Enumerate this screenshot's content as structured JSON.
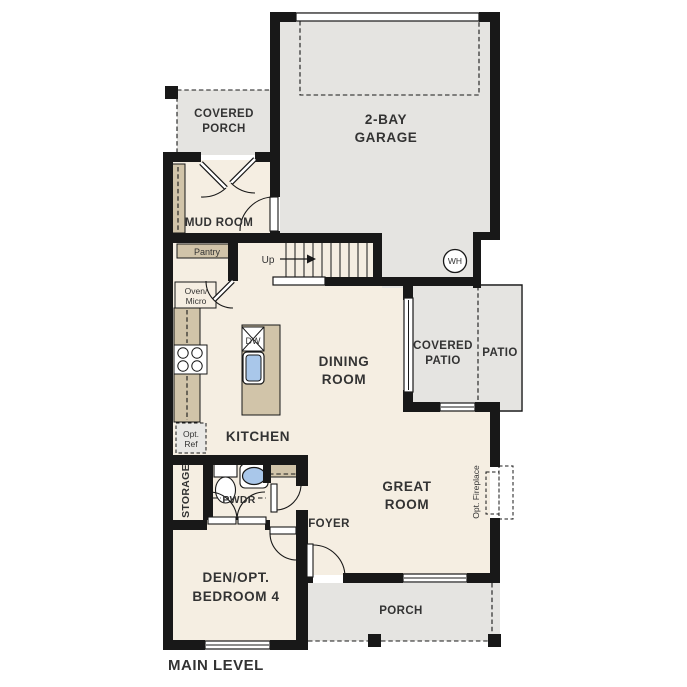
{
  "plan_title": "MAIN LEVEL",
  "rooms": {
    "garage": {
      "line1": "2-BAY",
      "line2": "GARAGE"
    },
    "covered_porch": {
      "line1": "COVERED",
      "line2": "PORCH"
    },
    "mud_room": {
      "label": "MUD ROOM"
    },
    "dining_room": {
      "line1": "DINING",
      "line2": "ROOM"
    },
    "kitchen": {
      "label": "KITCHEN"
    },
    "covered_patio": {
      "line1": "COVERED",
      "line2": "PATIO"
    },
    "patio": {
      "label": "PATIO"
    },
    "great_room": {
      "line1": "GREAT",
      "line2": "ROOM"
    },
    "powder": {
      "label": "PWDR"
    },
    "storage": {
      "label": "STORAGE"
    },
    "foyer": {
      "label": "FOYER"
    },
    "den": {
      "line1": "DEN/OPT.",
      "line2": "BEDROOM 4"
    },
    "porch": {
      "label": "PORCH"
    }
  },
  "fixtures": {
    "pantry": "Pantry",
    "oven_micro_line1": "Oven/",
    "oven_micro_line2": "Micro",
    "opt_ref_line1": "Opt.",
    "opt_ref_line2": "Ref",
    "dishwasher": "DW",
    "water_heater": "WH",
    "stairs_up": "Up",
    "opt_fireplace": "Opt. Fireplace"
  },
  "colors": {
    "floor": "#f5eee2",
    "outdoor": "#e5e4e1",
    "cabinet": "#d1c4a9",
    "wall": "#181818",
    "sink_blue": "#a9c7ea",
    "label_text": "#333333"
  }
}
